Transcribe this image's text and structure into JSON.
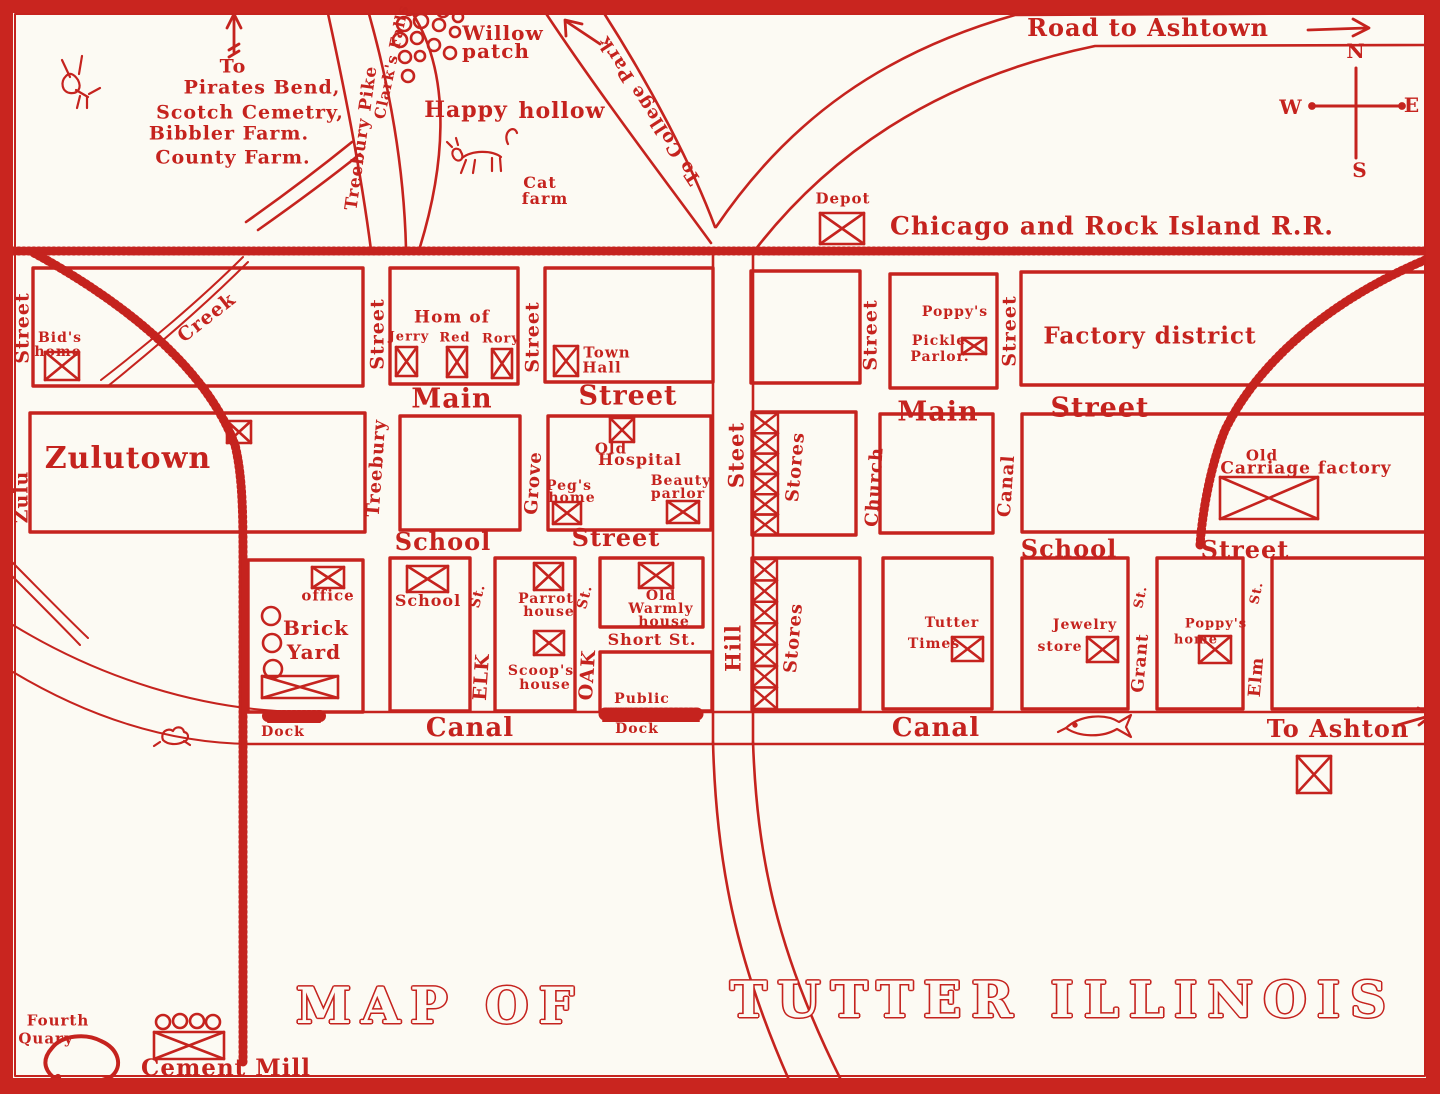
{
  "map_title": "MAP OF TUTTER ILLINOIS",
  "ink_color": "#c5231e",
  "background_color": "#fcfaf3",
  "compass": {
    "north": "N",
    "south": "S",
    "east": "E",
    "west": "W"
  },
  "railroad_name": "Chicago and Rock Island R.R.",
  "labels": [
    {
      "id": "to-direction",
      "text": "To",
      "x": 233,
      "y": 67,
      "size": 19
    },
    {
      "id": "pirates-bend",
      "text": "Pirates Bend,",
      "x": 262,
      "y": 88,
      "size": 19
    },
    {
      "id": "scotch-cemetry",
      "text": "Scotch Cemetry,",
      "x": 250,
      "y": 113,
      "size": 19
    },
    {
      "id": "bibbler-farm",
      "text": "Bibbler Farm.",
      "x": 229,
      "y": 134,
      "size": 19
    },
    {
      "id": "county-farm",
      "text": "County Farm.",
      "x": 233,
      "y": 158,
      "size": 19
    },
    {
      "id": "treebury-pike",
      "text": "Treebury Pike",
      "x": 362,
      "y": 138,
      "size": 17,
      "rot": -82
    },
    {
      "id": "clarks-falls",
      "text": "Clark's Falls",
      "x": 392,
      "y": 62,
      "size": 15,
      "rot": -78
    },
    {
      "id": "willow",
      "text": "Willow",
      "x": 503,
      "y": 33,
      "size": 20
    },
    {
      "id": "willow-patch",
      "text": "patch",
      "x": 496,
      "y": 51,
      "size": 20
    },
    {
      "id": "happy",
      "text": "Happy",
      "x": 466,
      "y": 110,
      "size": 22
    },
    {
      "id": "hollow",
      "text": "hollow",
      "x": 562,
      "y": 111,
      "size": 22
    },
    {
      "id": "cat",
      "text": "Cat",
      "x": 540,
      "y": 183,
      "size": 16
    },
    {
      "id": "cat-farm",
      "text": "farm",
      "x": 545,
      "y": 199,
      "size": 16
    },
    {
      "id": "to-college-park",
      "text": "To College Park",
      "x": 650,
      "y": 110,
      "size": 18,
      "rot": 237
    },
    {
      "id": "road-to-ashtown",
      "text": "Road to Ashtown",
      "x": 1148,
      "y": 28,
      "size": 24
    },
    {
      "id": "compass-n",
      "text": "N",
      "x": 1356,
      "y": 51,
      "size": 20
    },
    {
      "id": "compass-w",
      "text": "W",
      "x": 1291,
      "y": 107,
      "size": 20
    },
    {
      "id": "compass-e",
      "text": "E",
      "x": 1412,
      "y": 105,
      "size": 20
    },
    {
      "id": "compass-s",
      "text": "S",
      "x": 1360,
      "y": 170,
      "size": 20
    },
    {
      "id": "depot",
      "text": "Depot",
      "x": 843,
      "y": 199,
      "size": 15
    },
    {
      "id": "railroad-name",
      "text": "Chicago and Rock Island R.R.",
      "x": 1112,
      "y": 226,
      "size": 25
    },
    {
      "id": "zulu-street-upper",
      "text": "Street",
      "x": 23,
      "y": 328,
      "size": 19,
      "rot": -90
    },
    {
      "id": "bids",
      "text": "Bid's",
      "x": 60,
      "y": 338,
      "size": 14
    },
    {
      "id": "bids-home",
      "text": "home",
      "x": 58,
      "y": 352,
      "size": 14
    },
    {
      "id": "creek-upper",
      "text": "Creek",
      "x": 207,
      "y": 318,
      "size": 19,
      "rot": -38
    },
    {
      "id": "treebury-street-r1",
      "text": "Street",
      "x": 378,
      "y": 334,
      "size": 19,
      "rot": -90
    },
    {
      "id": "hom-of",
      "text": "Hom of",
      "x": 452,
      "y": 318,
      "size": 17
    },
    {
      "id": "jerry",
      "text": "Jerry",
      "x": 409,
      "y": 337,
      "size": 13
    },
    {
      "id": "red",
      "text": "Red",
      "x": 455,
      "y": 338,
      "size": 13
    },
    {
      "id": "rory",
      "text": "Rory",
      "x": 501,
      "y": 339,
      "size": 13
    },
    {
      "id": "grove-street-r1",
      "text": "Street",
      "x": 533,
      "y": 337,
      "size": 19,
      "rot": -90
    },
    {
      "id": "town",
      "text": "Town",
      "x": 607,
      "y": 353,
      "size": 15
    },
    {
      "id": "town-hall",
      "text": "Hall",
      "x": 602,
      "y": 368,
      "size": 15
    },
    {
      "id": "hill-steet",
      "text": "Steet",
      "x": 736,
      "y": 455,
      "size": 21,
      "rot": -90
    },
    {
      "id": "church-street-r1",
      "text": "Street",
      "x": 871,
      "y": 335,
      "size": 19,
      "rot": -90
    },
    {
      "id": "poppys-pickle-1",
      "text": "Poppy's",
      "x": 955,
      "y": 312,
      "size": 14
    },
    {
      "id": "poppys-pickle-2",
      "text": "Pickle",
      "x": 939,
      "y": 341,
      "size": 14
    },
    {
      "id": "poppys-pickle-3",
      "text": "Parlor.",
      "x": 940,
      "y": 357,
      "size": 14
    },
    {
      "id": "canal-street-r1",
      "text": "Street",
      "x": 1010,
      "y": 331,
      "size": 19,
      "rot": -90
    },
    {
      "id": "factory-district",
      "text": "Factory district",
      "x": 1150,
      "y": 336,
      "size": 23
    },
    {
      "id": "main-left",
      "text": "Main",
      "x": 452,
      "y": 399,
      "size": 27
    },
    {
      "id": "main-street-left",
      "text": "Street",
      "x": 628,
      "y": 396,
      "size": 27
    },
    {
      "id": "main-right",
      "text": "Main",
      "x": 938,
      "y": 412,
      "size": 27
    },
    {
      "id": "main-street-right",
      "text": "Street",
      "x": 1100,
      "y": 408,
      "size": 27
    },
    {
      "id": "zulu-street-lower",
      "text": "Zulu",
      "x": 22,
      "y": 497,
      "size": 19,
      "rot": -90
    },
    {
      "id": "zulutown",
      "text": "Zulutown",
      "x": 128,
      "y": 459,
      "size": 30
    },
    {
      "id": "treebury-r2",
      "text": "Treebury",
      "x": 377,
      "y": 468,
      "size": 18,
      "rot": -86
    },
    {
      "id": "grove-r2",
      "text": "Grove",
      "x": 534,
      "y": 483,
      "size": 18,
      "rot": -86
    },
    {
      "id": "old-hospital-1",
      "text": "Old",
      "x": 611,
      "y": 449,
      "size": 15
    },
    {
      "id": "old-hospital-2",
      "text": "Hospital",
      "x": 640,
      "y": 460,
      "size": 16
    },
    {
      "id": "pegs",
      "text": "Peg's",
      "x": 569,
      "y": 486,
      "size": 14
    },
    {
      "id": "pegs-home",
      "text": "home",
      "x": 572,
      "y": 498,
      "size": 14
    },
    {
      "id": "beauty",
      "text": "Beauty",
      "x": 681,
      "y": 481,
      "size": 14
    },
    {
      "id": "beauty-parlor",
      "text": "parlor",
      "x": 678,
      "y": 494,
      "size": 14
    },
    {
      "id": "stores-r2",
      "text": "Stores",
      "x": 796,
      "y": 467,
      "size": 18,
      "rot": -85
    },
    {
      "id": "church-r2",
      "text": "Church",
      "x": 875,
      "y": 487,
      "size": 18,
      "rot": -86
    },
    {
      "id": "canal-st-r2",
      "text": "Canal",
      "x": 1007,
      "y": 486,
      "size": 18,
      "rot": -86
    },
    {
      "id": "carriage-1",
      "text": "Old",
      "x": 1262,
      "y": 456,
      "size": 15
    },
    {
      "id": "carriage-2",
      "text": "Carriage factory",
      "x": 1306,
      "y": 469,
      "size": 17
    },
    {
      "id": "school-left",
      "text": "School",
      "x": 443,
      "y": 542,
      "size": 24
    },
    {
      "id": "school-street-left",
      "text": "Street",
      "x": 616,
      "y": 538,
      "size": 24
    },
    {
      "id": "school-right",
      "text": "School",
      "x": 1069,
      "y": 549,
      "size": 24
    },
    {
      "id": "school-street-right",
      "text": "Street",
      "x": 1245,
      "y": 550,
      "size": 24
    },
    {
      "id": "office",
      "text": "office",
      "x": 328,
      "y": 596,
      "size": 15
    },
    {
      "id": "brick",
      "text": "Brick",
      "x": 316,
      "y": 628,
      "size": 20
    },
    {
      "id": "brick-yard",
      "text": "Yard",
      "x": 314,
      "y": 652,
      "size": 20
    },
    {
      "id": "dock-left",
      "text": "Dock",
      "x": 283,
      "y": 732,
      "size": 14
    },
    {
      "id": "school-bldg",
      "text": "School",
      "x": 428,
      "y": 601,
      "size": 16
    },
    {
      "id": "elk-st",
      "text": "St.",
      "x": 478,
      "y": 596,
      "size": 14,
      "rot": -75
    },
    {
      "id": "elk",
      "text": "ELK",
      "x": 482,
      "y": 677,
      "size": 19,
      "rot": -86
    },
    {
      "id": "parrot",
      "text": "Parrot",
      "x": 546,
      "y": 599,
      "size": 14
    },
    {
      "id": "parrot-house",
      "text": "house",
      "x": 549,
      "y": 612,
      "size": 14
    },
    {
      "id": "scoops",
      "text": "Scoop's",
      "x": 541,
      "y": 671,
      "size": 14
    },
    {
      "id": "scoops-house",
      "text": "house",
      "x": 545,
      "y": 685,
      "size": 14
    },
    {
      "id": "oak-st",
      "text": "St.",
      "x": 585,
      "y": 597,
      "size": 14,
      "rot": -75
    },
    {
      "id": "oak",
      "text": "OAK",
      "x": 588,
      "y": 675,
      "size": 19,
      "rot": -86
    },
    {
      "id": "warmly-1",
      "text": "Old",
      "x": 661,
      "y": 596,
      "size": 14
    },
    {
      "id": "warmly-2",
      "text": "Warmly",
      "x": 661,
      "y": 609,
      "size": 14
    },
    {
      "id": "warmly-3",
      "text": "house",
      "x": 664,
      "y": 622,
      "size": 14
    },
    {
      "id": "short-st",
      "text": "Short St.",
      "x": 652,
      "y": 640,
      "size": 16
    },
    {
      "id": "public",
      "text": "Public",
      "x": 642,
      "y": 699,
      "size": 14
    },
    {
      "id": "public-dock",
      "text": "Dock",
      "x": 637,
      "y": 729,
      "size": 14
    },
    {
      "id": "hill",
      "text": "Hill",
      "x": 733,
      "y": 648,
      "size": 21,
      "rot": -90
    },
    {
      "id": "stores-r3",
      "text": "Stores",
      "x": 794,
      "y": 638,
      "size": 18,
      "rot": -85
    },
    {
      "id": "tutter-times-1",
      "text": "Tutter",
      "x": 952,
      "y": 623,
      "size": 14
    },
    {
      "id": "tutter-times-2",
      "text": "Times",
      "x": 934,
      "y": 644,
      "size": 14
    },
    {
      "id": "jewelry",
      "text": "Jewelry",
      "x": 1085,
      "y": 625,
      "size": 14
    },
    {
      "id": "jewelry-store",
      "text": "store",
      "x": 1060,
      "y": 647,
      "size": 14
    },
    {
      "id": "grant-st",
      "text": "St.",
      "x": 1141,
      "y": 597,
      "size": 13,
      "rot": -78
    },
    {
      "id": "grant",
      "text": "Grant",
      "x": 1141,
      "y": 663,
      "size": 17,
      "rot": -85
    },
    {
      "id": "poppys-home-1",
      "text": "Poppy's",
      "x": 1216,
      "y": 624,
      "size": 13
    },
    {
      "id": "poppys-home-2",
      "text": "home",
      "x": 1196,
      "y": 640,
      "size": 13
    },
    {
      "id": "elm-st",
      "text": "St.",
      "x": 1257,
      "y": 593,
      "size": 13,
      "rot": -78
    },
    {
      "id": "elm",
      "text": "Elm",
      "x": 1257,
      "y": 677,
      "size": 17,
      "rot": -85
    },
    {
      "id": "canal-left",
      "text": "Canal",
      "x": 470,
      "y": 728,
      "size": 26
    },
    {
      "id": "canal-right",
      "text": "Canal",
      "x": 936,
      "y": 728,
      "size": 26
    },
    {
      "id": "to-ashton",
      "text": "To Ashton",
      "x": 1338,
      "y": 729,
      "size": 24
    },
    {
      "id": "fourth",
      "text": "Fourth",
      "x": 58,
      "y": 1021,
      "size": 15
    },
    {
      "id": "fourth-quary",
      "text": "Quary",
      "x": 46,
      "y": 1039,
      "size": 15
    },
    {
      "id": "cement-mill",
      "text": "Cement Mill",
      "x": 226,
      "y": 1068,
      "size": 23
    },
    {
      "id": "map-of",
      "text": "MAP  OF",
      "x": 440,
      "y": 1006,
      "size": 50,
      "style": "outline"
    },
    {
      "id": "tutter-illinois",
      "text": "TUTTER  ILLINOIS",
      "x": 1063,
      "y": 1000,
      "size": 50,
      "style": "outline"
    }
  ]
}
